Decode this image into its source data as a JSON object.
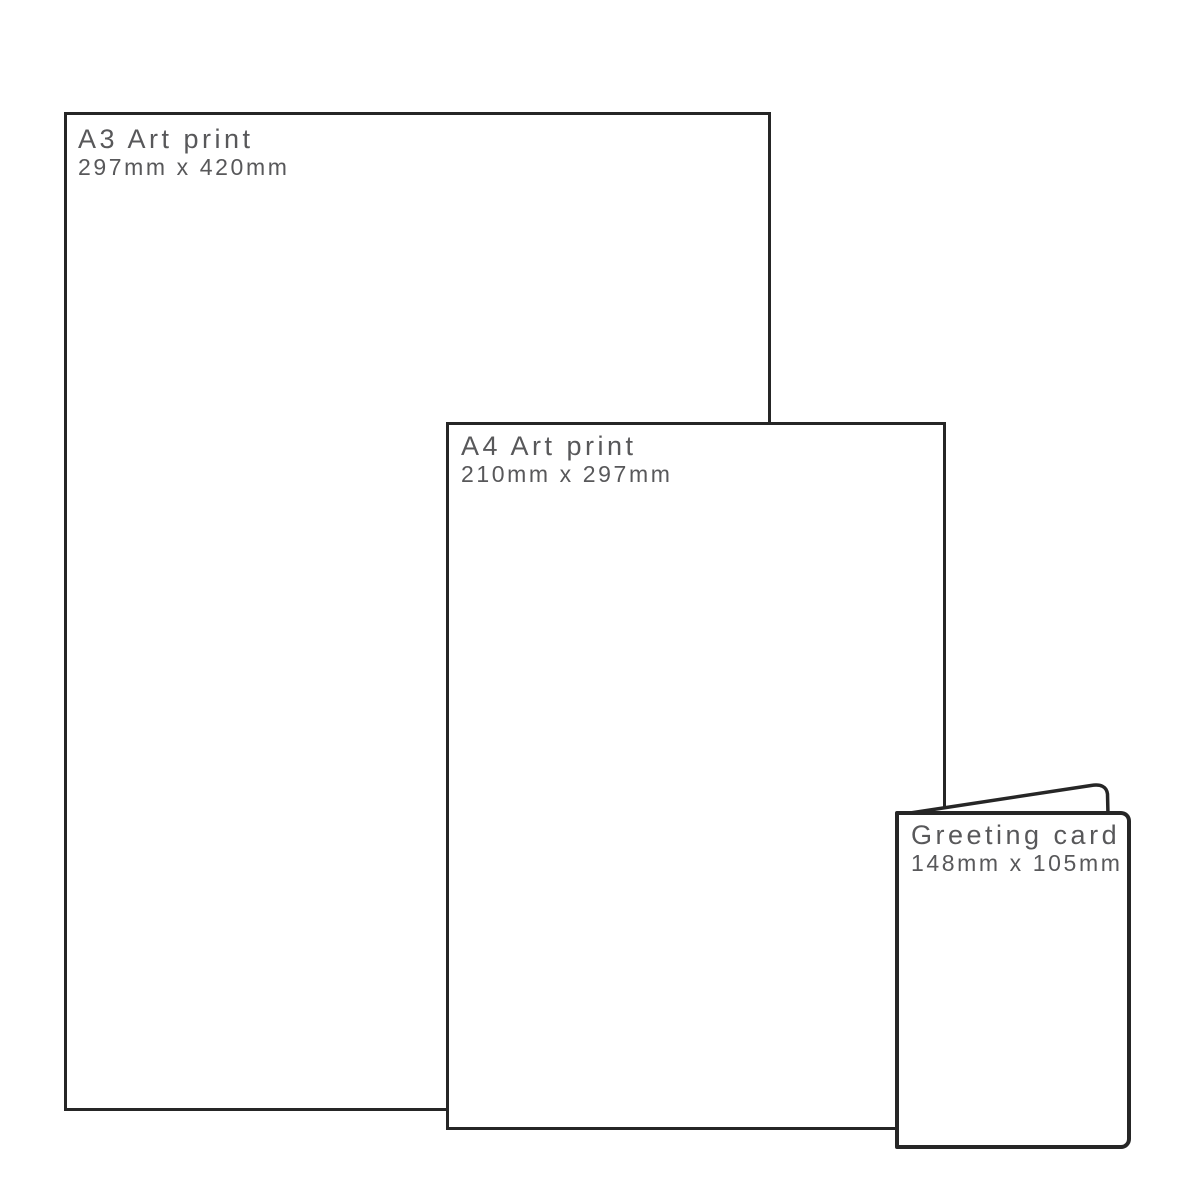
{
  "page": {
    "background": "#ffffff",
    "line_color": "#262626",
    "text_color": "#58585a"
  },
  "items": [
    {
      "id": "a3-art-print",
      "title": "A3 Art print",
      "dimensions": "297mm x 420mm"
    },
    {
      "id": "a4-art-print",
      "title": "A4 Art print",
      "dimensions": "210mm x 297mm"
    },
    {
      "id": "greeting-card",
      "title": "Greeting card",
      "dimensions": "148mm x 105mm"
    }
  ]
}
